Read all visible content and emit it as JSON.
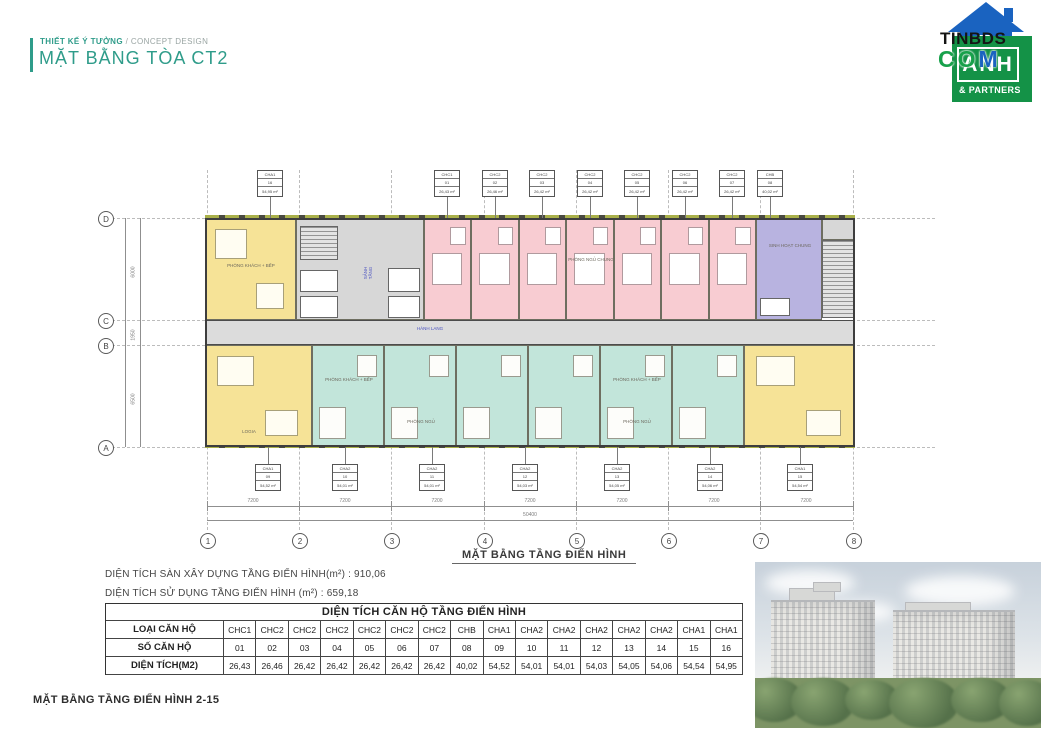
{
  "header": {
    "kicker": "THIẾT KẾ Ý TƯỞNG",
    "kicker2": " / CONCEPT DESIGN",
    "title": "MẶT BẰNG TÒA CT2",
    "accent_color": "#2f9c8a"
  },
  "logo": {
    "word1": "TINBDS",
    "word2_letters": [
      "C",
      "O",
      "M"
    ],
    "box_word": "ANH",
    "box_sub": "& PARTNERS",
    "green": "#149247",
    "blue": "#1a63c0"
  },
  "plan": {
    "caption": "MẶT BẰNG TẦNG ĐIỂN HÌNH",
    "grid_cols": [
      "1",
      "2",
      "3",
      "4",
      "5",
      "6",
      "7",
      "8"
    ],
    "grid_rows": [
      "D",
      "C",
      "B",
      "A"
    ],
    "dim_segments": [
      "7200",
      "7200",
      "7200",
      "7200",
      "7200",
      "7200",
      "7200"
    ],
    "dim_total": "50400",
    "dim_left": [
      "6000",
      "1950",
      "6500"
    ],
    "room_labels": [
      "PHÒNG KHÁCH + BẾP",
      "PHÒNG NGỦ CHUNG",
      "SINH HOẠT CHUNG",
      "HÀNH LANG",
      "SẢNH TẦNG",
      "PHÒNG KHÁCH + BẾP",
      "PHÒNG NGỦ",
      "PHÒNG NGỦ",
      "LOGIA",
      "PHÒNG KHÁCH + BẾP"
    ],
    "colors": {
      "yellow": "#f6e397",
      "pink": "#f8ccd2",
      "teal": "#c2e5da",
      "purple": "#b8b3e0",
      "core_gray": "#d7d7d7",
      "corridor_gray": "#dcdcdc"
    }
  },
  "tags": {
    "top": [
      {
        "type": "CHA1",
        "no": "16",
        "area": "54,95 m²"
      },
      {
        "type": "CHC1",
        "no": "01",
        "area": "26,43 m²"
      },
      {
        "type": "CHC2",
        "no": "02",
        "area": "26,46 m²"
      },
      {
        "type": "CHC2",
        "no": "03",
        "area": "26,42 m²"
      },
      {
        "type": "CHC2",
        "no": "04",
        "area": "26,42 m²"
      },
      {
        "type": "CHC2",
        "no": "05",
        "area": "26,42 m²"
      },
      {
        "type": "CHC2",
        "no": "06",
        "area": "26,42 m²"
      },
      {
        "type": "CHC2",
        "no": "07",
        "area": "26,42 m²"
      },
      {
        "type": "CHB",
        "no": "08",
        "area": "40,02 m²"
      }
    ],
    "bottom": [
      {
        "type": "CHA1",
        "no": "09",
        "area": "54,52 m²"
      },
      {
        "type": "CHA2",
        "no": "10",
        "area": "54,01 m²"
      },
      {
        "type": "CHA2",
        "no": "11",
        "area": "54,01 m²"
      },
      {
        "type": "CHA2",
        "no": "12",
        "area": "54,03 m²"
      },
      {
        "type": "CHA2",
        "no": "13",
        "area": "54,05 m²"
      },
      {
        "type": "CHA2",
        "no": "14",
        "area": "54,06 m²"
      },
      {
        "type": "CHA1",
        "no": "15",
        "area": "54,54 m²"
      }
    ]
  },
  "stats": {
    "line1": "DIỆN TÍCH SÀN XÂY DỰNG TẦNG ĐIỂN HÌNH(m²) : 910,06",
    "line2": "DIỆN TÍCH SỬ DỤNG TẦNG ĐIỂN HÌNH (m²) : 659,18"
  },
  "table": {
    "title": "DIỆN TÍCH CĂN HỘ TẦNG ĐIỂN HÌNH",
    "row_headers": [
      "LOẠI CĂN HỘ",
      "SỐ CĂN HỘ",
      "DIỆN TÍCH(M2)"
    ],
    "types": [
      "CHC1",
      "CHC2",
      "CHC2",
      "CHC2",
      "CHC2",
      "CHC2",
      "CHC2",
      "CHB",
      "CHA1",
      "CHA2",
      "CHA2",
      "CHA2",
      "CHA2",
      "CHA2",
      "CHA1",
      "CHA1"
    ],
    "numbers": [
      "01",
      "02",
      "03",
      "04",
      "05",
      "06",
      "07",
      "08",
      "09",
      "10",
      "11",
      "12",
      "13",
      "14",
      "15",
      "16"
    ],
    "areas": [
      "26,43",
      "26,46",
      "26,42",
      "26,42",
      "26,42",
      "26,42",
      "26,42",
      "40,02",
      "54,52",
      "54,01",
      "54,01",
      "54,03",
      "54,05",
      "54,06",
      "54,54",
      "54,95"
    ]
  },
  "footer": {
    "label": "MẶT BẰNG TẦNG ĐIỂN HÌNH 2-15"
  }
}
